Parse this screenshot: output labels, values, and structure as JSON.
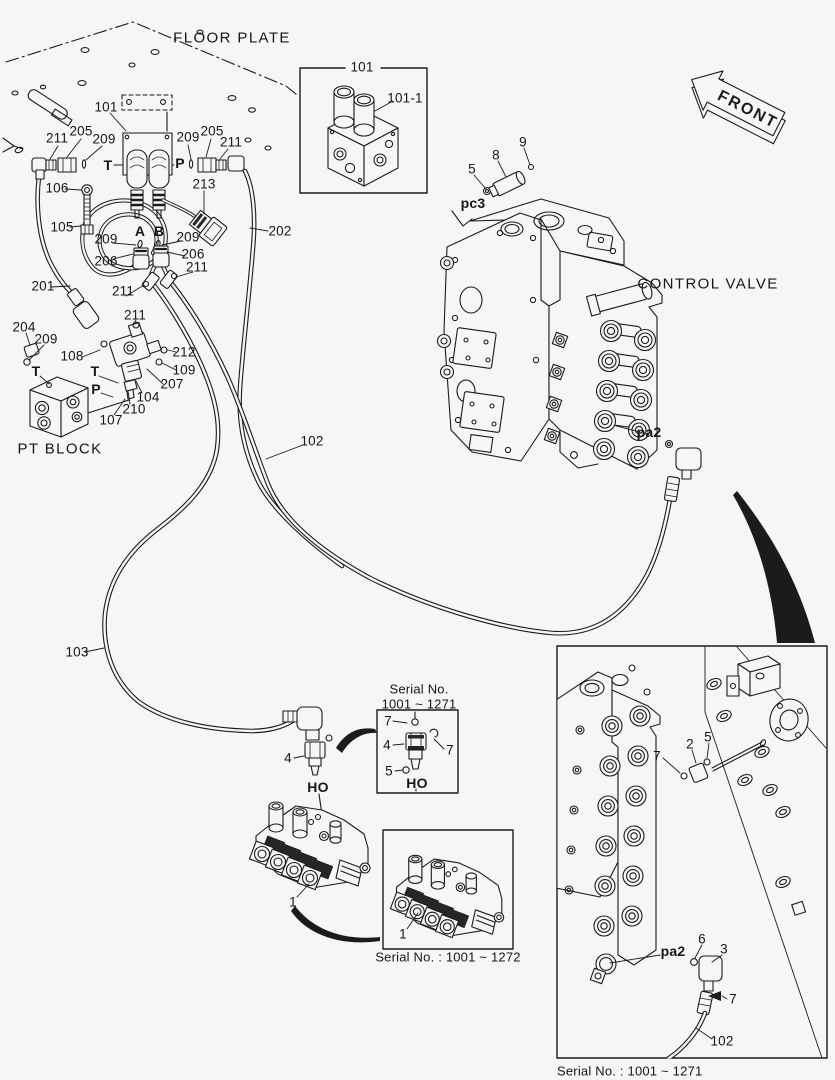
{
  "palette": {
    "background": "#f6f6f4",
    "ink": "#1b1b1b",
    "dark_fill": "#262626"
  },
  "front_arrow": {
    "label": "FRONT"
  },
  "captions": {
    "floor_plate": "FLOOR PLATE",
    "control_valve": "CONTROL VALVE",
    "pt_block": "PT BLOCK",
    "serial_fitting_line1": "Serial No.",
    "serial_fitting_line2": "1001 ~ 1271",
    "serial_manifold": "Serial No. : 1001 ~ 1272",
    "serial_valve_inset": "Serial No. : 1001 ~ 1271"
  },
  "callouts": [
    {
      "t": "FLOOR PLATE",
      "x": 232,
      "y": 38,
      "c": "area"
    },
    {
      "t": "101",
      "x": 106,
      "y": 107
    },
    {
      "t": "211",
      "x": 57,
      "y": 138
    },
    {
      "t": "205",
      "x": 81,
      "y": 131
    },
    {
      "t": "209",
      "x": 104,
      "y": 139
    },
    {
      "t": "T",
      "x": 108,
      "y": 165,
      "c": "b"
    },
    {
      "t": "209",
      "x": 188,
      "y": 137
    },
    {
      "t": "205",
      "x": 212,
      "y": 131
    },
    {
      "t": "211",
      "x": 231,
      "y": 142
    },
    {
      "t": "P",
      "x": 180,
      "y": 163,
      "c": "b"
    },
    {
      "t": "106",
      "x": 57,
      "y": 188
    },
    {
      "t": "105",
      "x": 62,
      "y": 227
    },
    {
      "t": "213",
      "x": 204,
      "y": 184
    },
    {
      "t": "202",
      "x": 280,
      "y": 231
    },
    {
      "t": "A",
      "x": 140,
      "y": 231,
      "c": "b"
    },
    {
      "t": "B",
      "x": 159,
      "y": 231,
      "c": "b"
    },
    {
      "t": "209",
      "x": 106,
      "y": 239
    },
    {
      "t": "209",
      "x": 188,
      "y": 237
    },
    {
      "t": "206",
      "x": 106,
      "y": 261
    },
    {
      "t": "206",
      "x": 193,
      "y": 254
    },
    {
      "t": "211",
      "x": 197,
      "y": 267
    },
    {
      "t": "201",
      "x": 43,
      "y": 286
    },
    {
      "t": "211",
      "x": 123,
      "y": 291
    },
    {
      "t": "211",
      "x": 135,
      "y": 315
    },
    {
      "t": "204",
      "x": 24,
      "y": 327
    },
    {
      "t": "209",
      "x": 46,
      "y": 339
    },
    {
      "t": "108",
      "x": 72,
      "y": 356
    },
    {
      "t": "212",
      "x": 184,
      "y": 352
    },
    {
      "t": "109",
      "x": 184,
      "y": 370
    },
    {
      "t": "207",
      "x": 172,
      "y": 384
    },
    {
      "t": "104",
      "x": 148,
      "y": 397
    },
    {
      "t": "210",
      "x": 134,
      "y": 409
    },
    {
      "t": "107",
      "x": 111,
      "y": 420
    },
    {
      "t": "T",
      "x": 36,
      "y": 371,
      "c": "b"
    },
    {
      "t": "T",
      "x": 95,
      "y": 371,
      "c": "b"
    },
    {
      "t": "P",
      "x": 96,
      "y": 389,
      "c": "b"
    },
    {
      "t": "PT BLOCK",
      "x": 60,
      "y": 449,
      "c": "area"
    },
    {
      "t": "5",
      "x": 472,
      "y": 169
    },
    {
      "t": "8",
      "x": 496,
      "y": 155
    },
    {
      "t": "9",
      "x": 523,
      "y": 142
    },
    {
      "t": "pc3",
      "x": 473,
      "y": 203,
      "c": "b"
    },
    {
      "t": "CONTROL VALVE",
      "x": 708,
      "y": 284,
      "c": "area"
    },
    {
      "t": "pa2",
      "x": 649,
      "y": 432,
      "c": "b"
    },
    {
      "t": "102",
      "x": 312,
      "y": 441
    },
    {
      "t": "103",
      "x": 77,
      "y": 652
    },
    {
      "t": "Serial No.",
      "x": 419,
      "y": 689,
      "c": "cap"
    },
    {
      "t": "1001 ~ 1271",
      "x": 419,
      "y": 704,
      "c": "cap"
    },
    {
      "t": "7",
      "x": 388,
      "y": 721
    },
    {
      "t": "4",
      "x": 387,
      "y": 745
    },
    {
      "t": "7",
      "x": 450,
      "y": 750
    },
    {
      "t": "5",
      "x": 389,
      "y": 771
    },
    {
      "t": "HO",
      "x": 417,
      "y": 783,
      "c": "b"
    },
    {
      "t": "4",
      "x": 288,
      "y": 758
    },
    {
      "t": "HO",
      "x": 318,
      "y": 787,
      "c": "b"
    },
    {
      "t": "101",
      "x": 362,
      "y": 67
    },
    {
      "t": "101-1",
      "x": 405,
      "y": 98
    },
    {
      "t": "1",
      "x": 293,
      "y": 902
    },
    {
      "t": "1",
      "x": 403,
      "y": 934
    },
    {
      "t": "Serial No. : 1001 ~ 1272",
      "x": 448,
      "y": 957,
      "c": "cap"
    },
    {
      "t": "7",
      "x": 657,
      "y": 756
    },
    {
      "t": "2",
      "x": 690,
      "y": 744
    },
    {
      "t": "5",
      "x": 708,
      "y": 737
    },
    {
      "t": "6",
      "x": 702,
      "y": 939
    },
    {
      "t": "3",
      "x": 724,
      "y": 949
    },
    {
      "t": "pa2",
      "x": 673,
      "y": 951,
      "c": "b"
    },
    {
      "t": "7",
      "x": 733,
      "y": 999
    },
    {
      "t": "102",
      "x": 722,
      "y": 1041
    },
    {
      "t": "Serial No. : 1001 ~ 1271",
      "x": 557,
      "y": 1071,
      "c": "cap",
      "a": "l"
    }
  ]
}
